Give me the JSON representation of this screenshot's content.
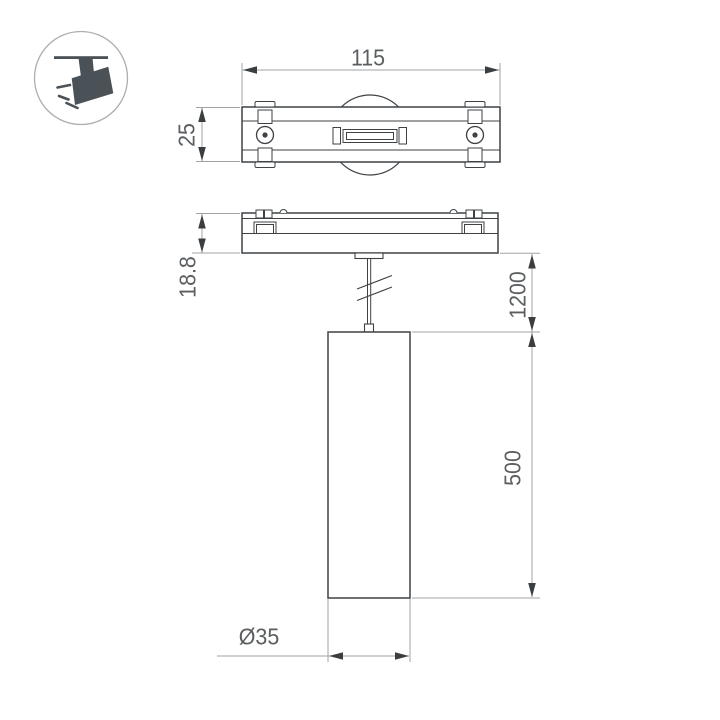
{
  "drawing_type": "technical dimension drawing of magnetic track pendant luminaire",
  "icon": {
    "name": "track-spotlight-icon"
  },
  "dimensions": {
    "track_width": "115",
    "track_depth": "25",
    "adapter_height": "18.8",
    "suspension_length": "1200",
    "body_length": "500",
    "body_diameter": "Ø35"
  },
  "colors": {
    "object_line": "#3e4245",
    "dimension_line": "#a0a3a6",
    "arrow": "#3a3e41",
    "text": "#5a5e61",
    "icon_fill": "#4a5157",
    "icon_ring": "#abaeb0",
    "background": "#ffffff"
  }
}
